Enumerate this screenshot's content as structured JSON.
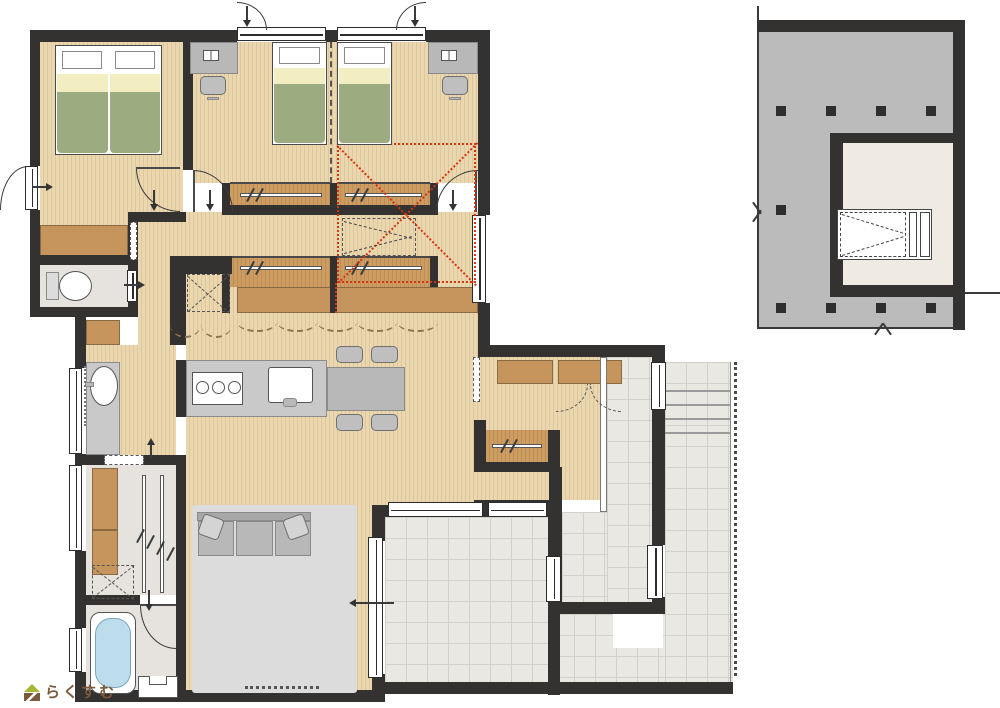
{
  "logo": {
    "text": "らくすむ"
  },
  "colors": {
    "wall": "#333230",
    "wood": "#ead7b0",
    "woodLine": "#dfc79c",
    "closet": "#cd9c63",
    "closetLine": "#c08e52",
    "cab": "#c6955d",
    "counter": "#c9c9c9",
    "furn": "#b8b8b8",
    "tile": "#e9e8e3",
    "tileLine": "#d2d1ca",
    "mat": "#e6e3de",
    "rug": "#dcdcdc",
    "bedGreen": "#9dac80",
    "bedCream": "#f3edc2",
    "tub": "#bddcec",
    "loftGray": "#bbbbbb",
    "loftRoom": "#f0ebe2",
    "red": "#d3350f",
    "logoBrown": "#7b5a3c",
    "logoGreen": "#a8b832"
  }
}
